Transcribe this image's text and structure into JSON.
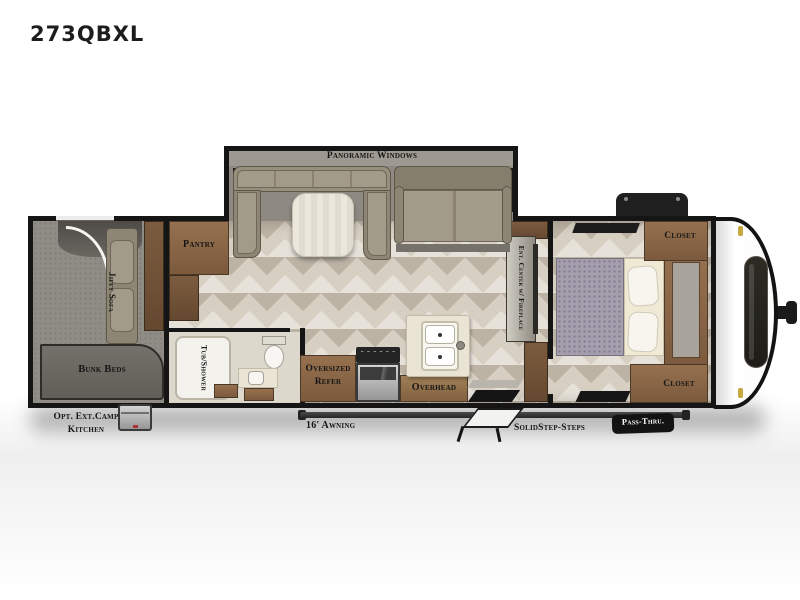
{
  "title": "273QBXL",
  "floorplan": {
    "slide": {
      "label": "Panoramic Windows"
    },
    "interior": {
      "pantry": "Pantry",
      "jiffy_sofa": "Jiffy Sofa",
      "bunk_beds": "Bunk Beds",
      "tub_shower": "Tub/Shower",
      "refer_line1": "Oversized",
      "refer_line2": "Refer",
      "overhead": "Overhead",
      "ent_center": "Ent. Center w/ Fireplace",
      "closet_top": "Closet",
      "closet_bottom": "Closet"
    },
    "exterior": {
      "camp_kitchen_line1": "Opt. Ext.Camp",
      "camp_kitchen_line2": "Kitchen",
      "awning": "16' Awning",
      "steps": "SolidStep-Steps",
      "pass_thru": "Pass-Thru."
    }
  },
  "colors": {
    "wall": "#151515",
    "floorA": "#d7cfc2",
    "carpet": "#8f8b85",
    "uph": "#8e8674",
    "uphLight": "#a39b89",
    "wood": "#8a6a4c",
    "counter": "#eae4d4",
    "capWhite": "#fdfdfd",
    "labelInk": "#161616",
    "markerYellow": "#c9a83f"
  }
}
